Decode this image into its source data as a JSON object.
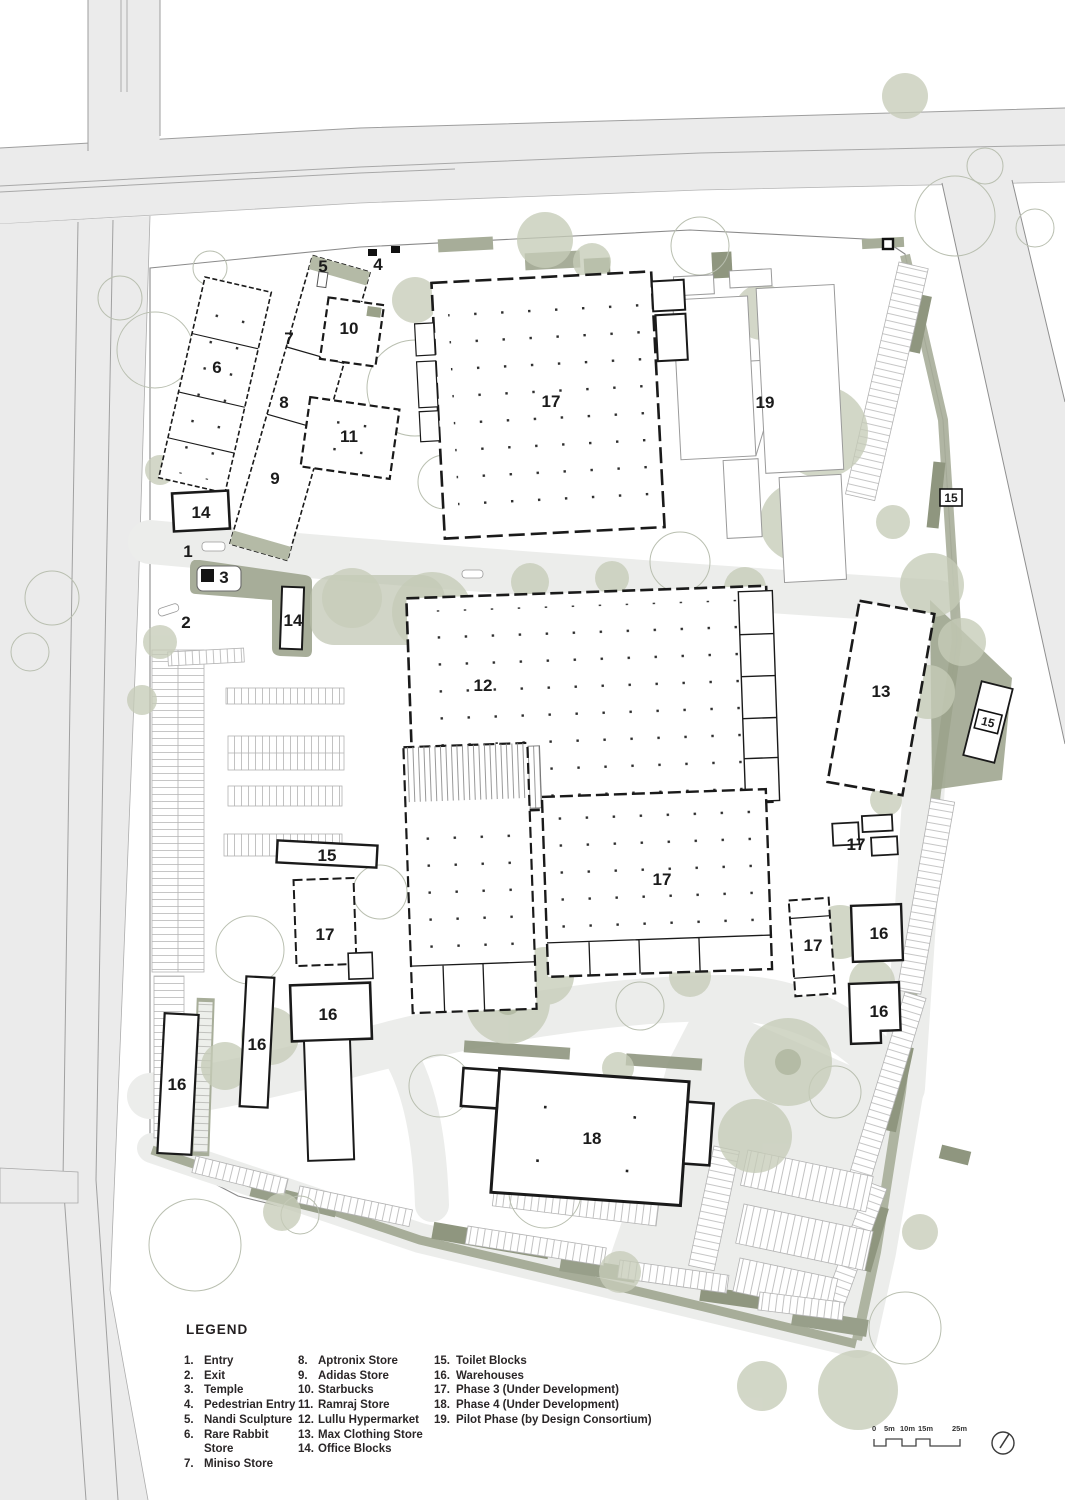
{
  "plan": {
    "labels": {
      "entry": "1",
      "exit": "2",
      "temple": "3",
      "pedestrian_entry": "4",
      "nandi": "5",
      "rare_rabbit": "6",
      "miniso": "7",
      "aptronix": "8",
      "adidas": "9",
      "starbucks": "10",
      "ramraj": "11",
      "lullu": "12",
      "max": "13",
      "office_a": "14",
      "office_b": "14",
      "toilet_a": "15",
      "toilet_b": "15",
      "toilet_c": "15",
      "warehouse_a": "16",
      "warehouse_b": "16",
      "warehouse_c": "16",
      "warehouse_d": "16",
      "warehouse_e": "16",
      "phase3_a": "17",
      "phase3_b": "17",
      "phase3_c": "17",
      "phase3_d": "17",
      "phase3_e": "17",
      "phase4": "18",
      "pilot": "19"
    }
  },
  "legend": {
    "title": "LEGEND",
    "columns": [
      {
        "items": [
          {
            "num": "1.",
            "label": "Entry"
          },
          {
            "num": "2.",
            "label": "Exit"
          },
          {
            "num": "3.",
            "label": "Temple"
          },
          {
            "num": "4.",
            "label": "Pedestrian Entry"
          },
          {
            "num": "5.",
            "label": "Nandi Sculpture"
          },
          {
            "num": "6.",
            "label": "Rare Rabbit Store"
          },
          {
            "num": "7.",
            "label": "Miniso Store"
          }
        ]
      },
      {
        "items": [
          {
            "num": "8.",
            "label": "Aptronix Store"
          },
          {
            "num": "9.",
            "label": "Adidas Store"
          },
          {
            "num": "10.",
            "label": "Starbucks"
          },
          {
            "num": "11.",
            "label": "Ramraj Store"
          },
          {
            "num": "12.",
            "label": "Lullu Hypermarket"
          },
          {
            "num": "13.",
            "label": "Max Clothing Store"
          },
          {
            "num": "14.",
            "label": "Office Blocks"
          }
        ]
      },
      {
        "items": [
          {
            "num": "15.",
            "label": "Toilet Blocks"
          },
          {
            "num": "16.",
            "label": "Warehouses"
          },
          {
            "num": "17.",
            "label": "Phase 3 (Under Development)"
          },
          {
            "num": "18.",
            "label": "Phase 4 (Under Development)"
          },
          {
            "num": "19.",
            "label": "Pilot Phase (by Design Consortium)"
          }
        ]
      }
    ]
  },
  "scale_bar": {
    "labels": [
      "0",
      "5m",
      "10m",
      "15m",
      "25m"
    ]
  },
  "colors": {
    "road": "#ebebeb",
    "internal_paving": "#ecedeb",
    "green_strip": "#a7ad99",
    "green_dark": "#8f967f",
    "tree_fill": "#c6ccb8",
    "tree_outline": "#b9bfb0",
    "building_outline": "#1a1a1a"
  }
}
